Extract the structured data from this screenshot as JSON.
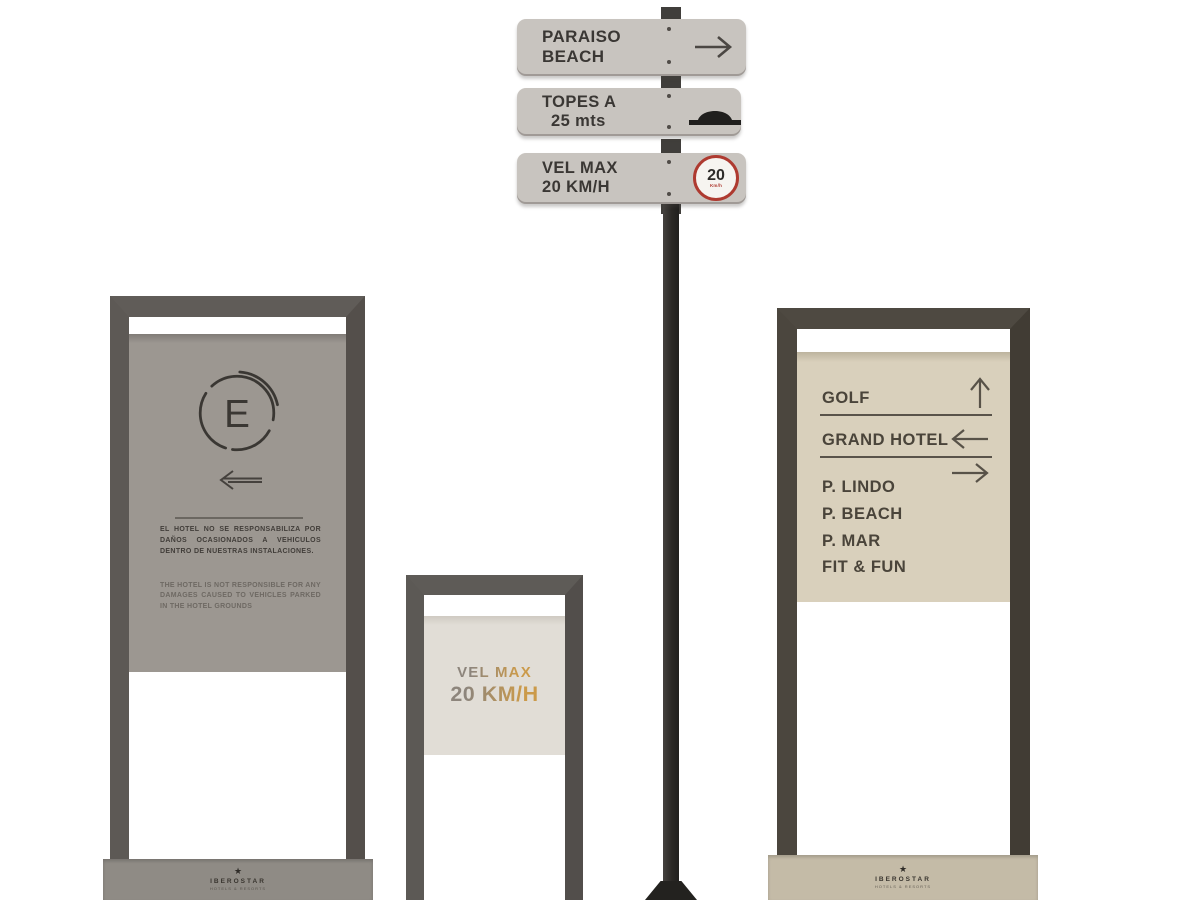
{
  "signpost": {
    "plates": [
      {
        "line1": "PARAISO",
        "line2": "BEACH",
        "icon": "arrow-right-icon"
      },
      {
        "line1": "TOPES A",
        "line2": "25 mts",
        "icon": "speed-bump-icon"
      },
      {
        "line1": "VEL MAX",
        "line2": "20 KM/H",
        "icon": "speed-limit-badge",
        "badge": {
          "value": "20",
          "unit": "Km/h"
        }
      }
    ],
    "colors": {
      "plate_bg": "#c8c4bf",
      "plate_text": "#3a3734",
      "pole": "#2b2926",
      "badge_ring": "#ae3a30"
    }
  },
  "parking_sign": {
    "symbol_letter": "E",
    "direction_icon": "arrow-left-icon",
    "disclaimer_es": "EL HOTEL NO SE RESPONSABILIZA POR DAÑOS OCASIONADOS A VEHICULOS DENTRO DE NUESTRAS INSTALACIONES.",
    "disclaimer_en": "THE HOTEL IS NOT RESPONSIBLE FOR ANY DAMAGES CAUSED TO VEHICLES PARKED IN THE HOTEL GROUNDS",
    "brand": {
      "star": "★",
      "name": "IBEROSTAR",
      "tagline": "HOTELS & RESORTS"
    },
    "colors": {
      "frame": "#605c58",
      "panel": "#9c9791",
      "plinth": "#8f8b85",
      "ink": "#3a3734"
    }
  },
  "speed_panel_sign": {
    "line1": "VEL MAX",
    "line2": "20 KM/H",
    "colors": {
      "frame": "#5e5b57",
      "panel": "#e1ddd6",
      "text_gradient_from": "#8d857c",
      "text_gradient_to": "#cb9a4a"
    }
  },
  "wayfinding_sign": {
    "rows": [
      {
        "label": "GOLF",
        "icon": "arrow-up-icon",
        "underline": true
      },
      {
        "label": "GRAND HOTEL",
        "icon": "arrow-left-icon",
        "underline": true
      },
      {
        "label": "P. LINDO",
        "icon": "arrow-right-icon",
        "underline": false
      },
      {
        "label": "P. BEACH",
        "icon": "",
        "underline": false
      },
      {
        "label": "P. MAR",
        "icon": "",
        "underline": false
      },
      {
        "label": "FIT & FUN",
        "icon": "",
        "underline": false
      }
    ],
    "brand": {
      "star": "★",
      "name": "IBEROSTAR",
      "tagline": "HOTELS & RESORTS"
    },
    "colors": {
      "frame": "#4e4941",
      "panel": "#d9d0bc",
      "plinth": "#c4bba7",
      "ink": "#4a443a"
    }
  }
}
